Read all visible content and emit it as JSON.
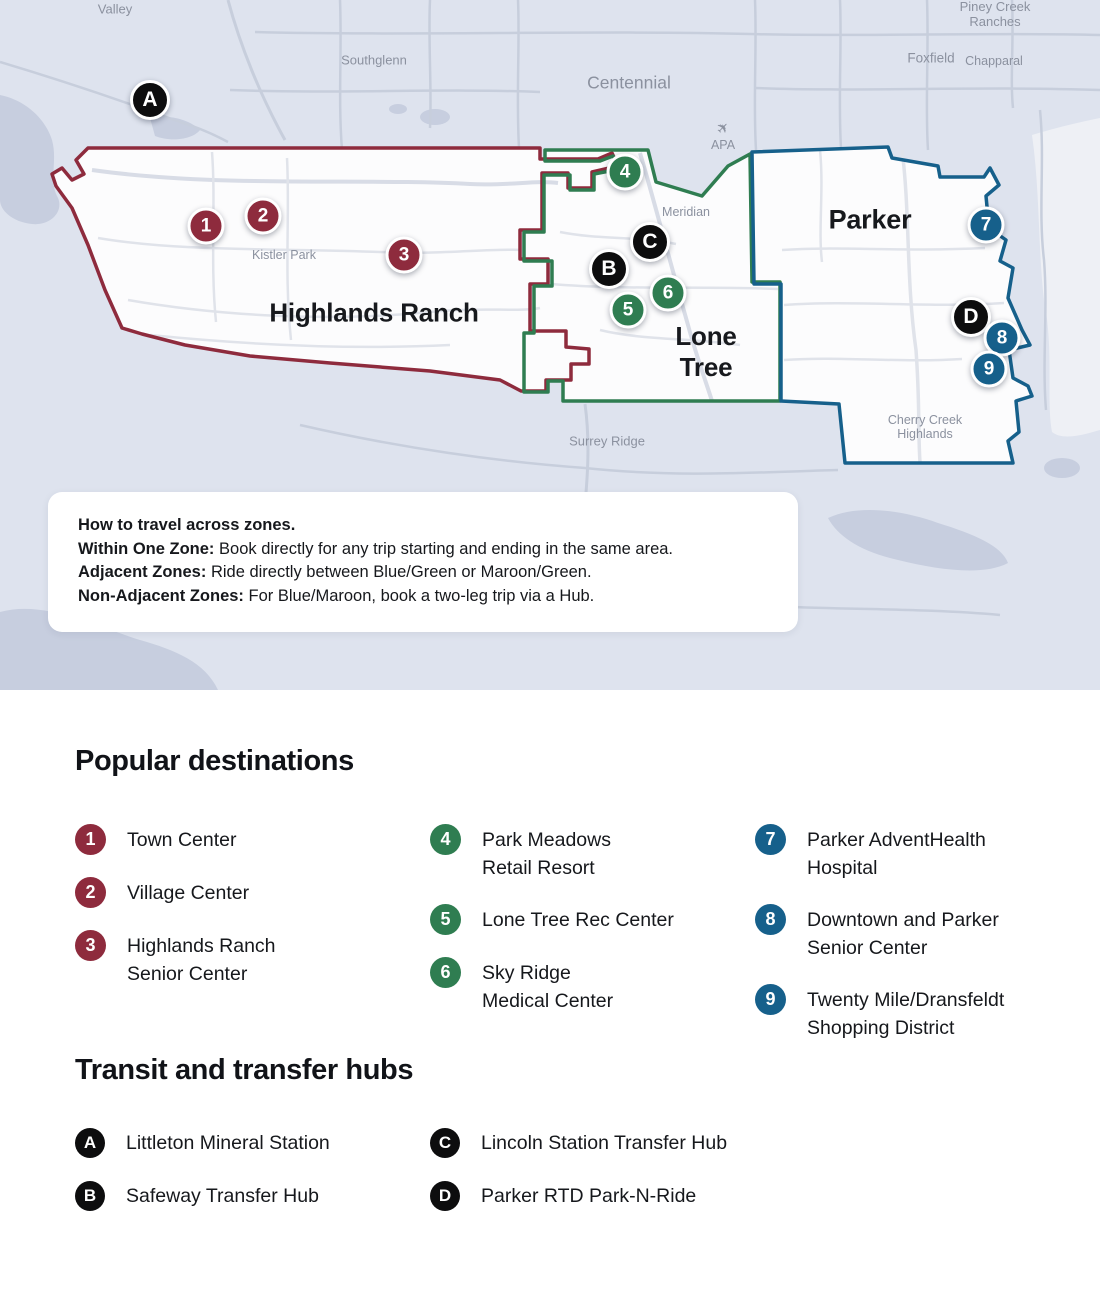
{
  "map": {
    "zones": [
      {
        "name": "Highlands Ranch",
        "label": "Highlands Ranch",
        "color": "#8E2B3D",
        "color_name": "Maroon"
      },
      {
        "name": "Lone Tree",
        "label": "Lone\nTree",
        "color": "#2F7D51",
        "color_name": "Green"
      },
      {
        "name": "Parker",
        "label": "Parker",
        "color": "#16608B",
        "color_name": "Blue"
      }
    ],
    "place_labels": [
      {
        "text": "Valley"
      },
      {
        "text": "Southglenn"
      },
      {
        "text": "Centennial"
      },
      {
        "text": "Piney Creek Ranches"
      },
      {
        "text": "Foxfield"
      },
      {
        "text": "Chapparal"
      },
      {
        "text": "Kistler Park"
      },
      {
        "text": "Meridian"
      },
      {
        "text": "APA"
      },
      {
        "text": "Surrey Ridge"
      },
      {
        "text": "Cherry Creek\nHighlands"
      }
    ],
    "markers": [
      {
        "label": "A",
        "kind": "hub"
      },
      {
        "label": "1",
        "kind": "destination"
      },
      {
        "label": "2",
        "kind": "destination"
      },
      {
        "label": "3",
        "kind": "destination"
      },
      {
        "label": "4",
        "kind": "destination"
      },
      {
        "label": "C",
        "kind": "hub"
      },
      {
        "label": "B",
        "kind": "hub"
      },
      {
        "label": "5",
        "kind": "destination"
      },
      {
        "label": "6",
        "kind": "destination"
      },
      {
        "label": "7",
        "kind": "destination"
      },
      {
        "label": "D",
        "kind": "hub"
      },
      {
        "label": "8",
        "kind": "destination"
      },
      {
        "label": "9",
        "kind": "destination"
      }
    ]
  },
  "info_box": {
    "title": "How to travel across zones.",
    "lines": [
      {
        "bold": "Within One Zone:",
        "text": " Book directly for any trip starting and ending in the same area."
      },
      {
        "bold": "Adjacent Zones:",
        "text": " Ride directly between Blue/Green or Maroon/Green."
      },
      {
        "bold": "Non-Adjacent Zones:",
        "text": " For Blue/Maroon, book a two-leg trip via a Hub."
      }
    ]
  },
  "popular_destinations": {
    "heading": "Popular destinations",
    "items": [
      {
        "number": "1",
        "label": "Town Center"
      },
      {
        "number": "2",
        "label": "Village Center"
      },
      {
        "number": "3",
        "label": "Highlands Ranch\nSenior Center"
      },
      {
        "number": "4",
        "label": "Park Meadows\nRetail Resort"
      },
      {
        "number": "5",
        "label": "Lone Tree Rec Center"
      },
      {
        "number": "6",
        "label": "Sky Ridge\nMedical Center"
      },
      {
        "number": "7",
        "label": "Parker AdventHealth\nHospital"
      },
      {
        "number": "8",
        "label": "Downtown and Parker\nSenior Center"
      },
      {
        "number": "9",
        "label": "Twenty Mile/Dransfeldt\nShopping District"
      }
    ]
  },
  "transit_hubs": {
    "heading": "Transit and transfer hubs",
    "items": [
      {
        "letter": "A",
        "label": "Littleton Mineral Station"
      },
      {
        "letter": "B",
        "label": "Safeway Transfer Hub"
      },
      {
        "letter": "C",
        "label": "Lincoln Station Transfer Hub"
      },
      {
        "letter": "D",
        "label": "Parker RTD Park-N-Ride"
      }
    ]
  },
  "colors": {
    "maroon": "#8E2B3D",
    "green": "#2F7D51",
    "blue": "#16608B",
    "hub_black": "#0D0D0E",
    "map_background": "#DEE3EE",
    "water": "#C7CEDF"
  }
}
